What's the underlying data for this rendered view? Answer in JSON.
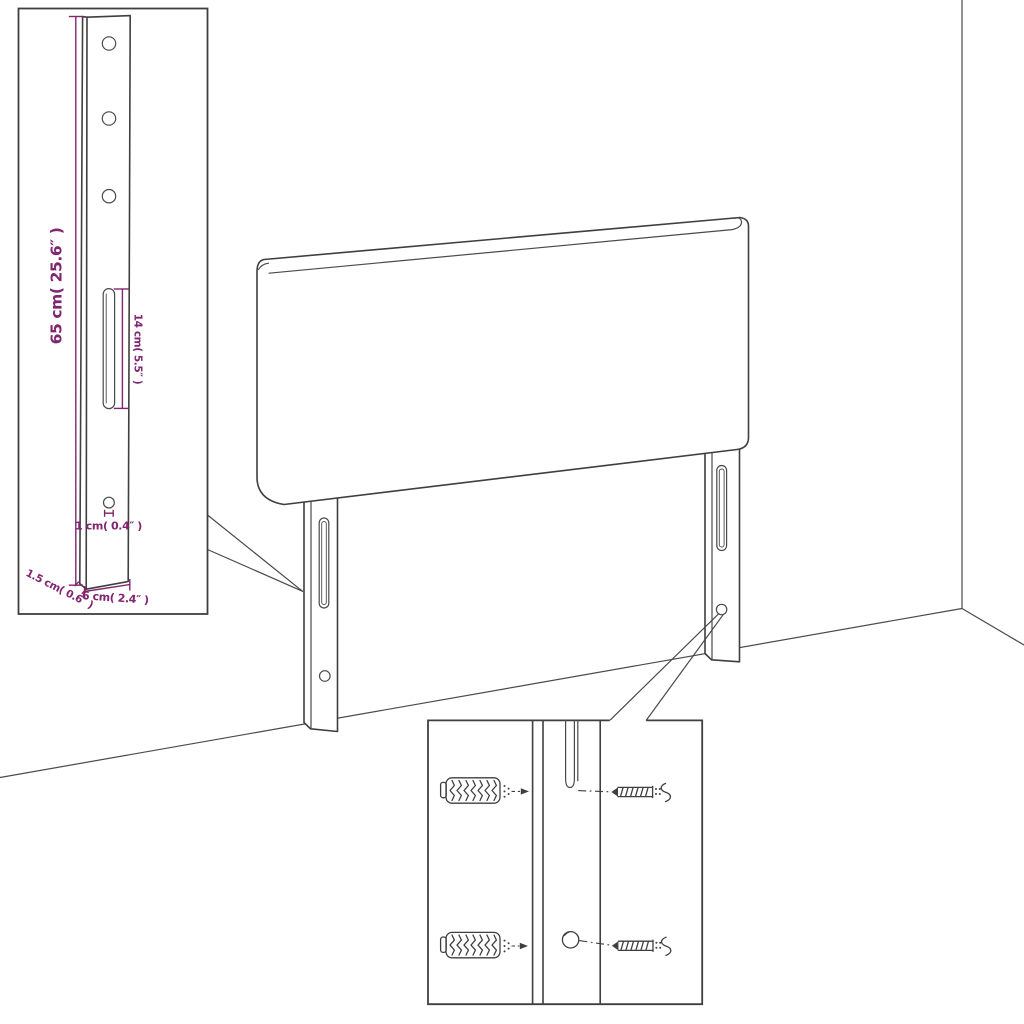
{
  "diagram": {
    "kind": "furniture-assembly-diagram",
    "subject": "headboard-with-mounting-legs",
    "colors": {
      "line": "#3f3f3f",
      "dimension": "#822570",
      "background": "#ffffff"
    }
  },
  "labels": {
    "bracket_height": "65 cm( 25.6″ )",
    "slot_length": "14 cm( 5.5″ )",
    "hole_diameter": "1 cm( 0.4″ )",
    "bracket_width": "6 cm( 2.4″ )",
    "bracket_thickness": "1.5 cm( 0.6″ )"
  }
}
